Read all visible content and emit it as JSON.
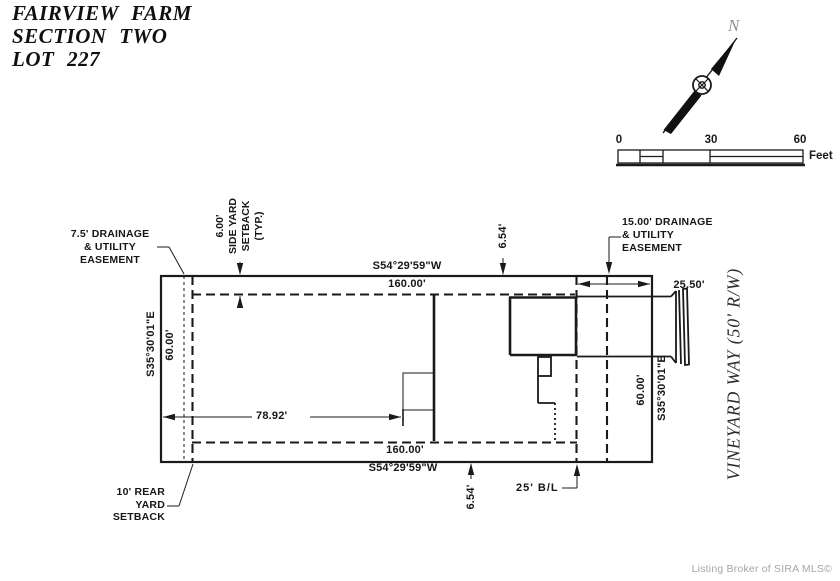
{
  "title": {
    "line1": "FAIRVIEW FARM",
    "line2": "SECTION TWO",
    "line3": "LOT 227"
  },
  "north_label": "N",
  "scale_bar": {
    "t0": "0",
    "t30": "30",
    "t60": "60",
    "unit": "Feet"
  },
  "labels": {
    "easement_left": {
      "l1": "7.5' DRAINAGE",
      "l2": "& UTILITY",
      "l3": "EASEMENT"
    },
    "side_yard": {
      "l1": "6.00'",
      "l2": "SIDE YARD",
      "l3": "SETBACK",
      "l4": "(TYP.)"
    },
    "easement_right": {
      "l1": "15.00' DRAINAGE",
      "l2": "& UTILITY",
      "l3": "EASEMENT"
    },
    "rear_yard": {
      "l1": "10' REAR",
      "l2": "YARD",
      "l3": "SETBACK"
    },
    "building_line": "25' B/L",
    "street": "VINEYARD WAY (50' R/W)"
  },
  "dims": {
    "top_bearing": "S54°29'59\"W",
    "top_length": "160.00'",
    "bottom_length": "160.00'",
    "bottom_bearing": "S54°29'59\"W",
    "left_bearing": "S35°30'01\"E",
    "left_length": "60.00'",
    "right_length": "60.00'",
    "right_bearing": "S35°30'01\"E",
    "front_width": "25.50'",
    "house_setback": "78.92'",
    "gap_top": "6.54'",
    "gap_bottom": "6.54'"
  },
  "footer": "Listing Broker of SIRA MLS©",
  "colors": {
    "ink": "#1a1a1a",
    "muted": "#a6a6a6"
  }
}
